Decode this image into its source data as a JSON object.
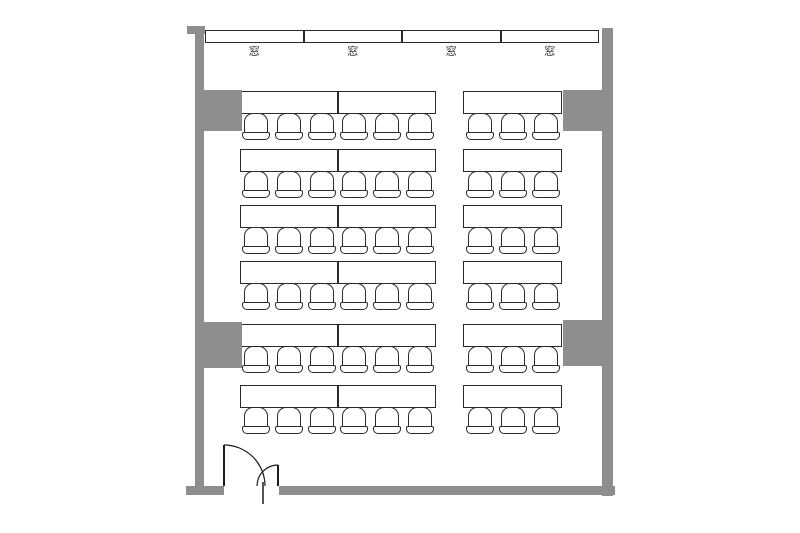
{
  "plan": {
    "colors": {
      "wall": "#8e8e8e",
      "line": "#2b2b2b",
      "floor": "#ffffff"
    },
    "windows": {
      "labels": [
        "窓",
        "窓",
        "窓",
        "窓"
      ]
    },
    "seating": {
      "rows": 6,
      "row_desk_y": [
        91,
        149,
        205,
        261,
        324,
        385
      ],
      "desk_height": 23,
      "groups": [
        {
          "name": "left-block",
          "x": 240,
          "width": 196,
          "desks": 2,
          "seats_per_row": 6
        },
        {
          "name": "right-block",
          "x": 463,
          "width": 99,
          "desks": 1,
          "seats_per_row": 3
        }
      ],
      "total_desks": 18,
      "total_seats": 54
    },
    "pillars": [
      {
        "x": 204,
        "y": 90,
        "w": 38,
        "h": 41
      },
      {
        "x": 204,
        "y": 322,
        "w": 38,
        "h": 46
      },
      {
        "x": 563,
        "y": 90,
        "w": 39,
        "h": 41
      },
      {
        "x": 563,
        "y": 320,
        "w": 39,
        "h": 46
      }
    ],
    "door": {
      "type": "double-swing",
      "opening_x": 224,
      "opening_width": 55
    }
  }
}
